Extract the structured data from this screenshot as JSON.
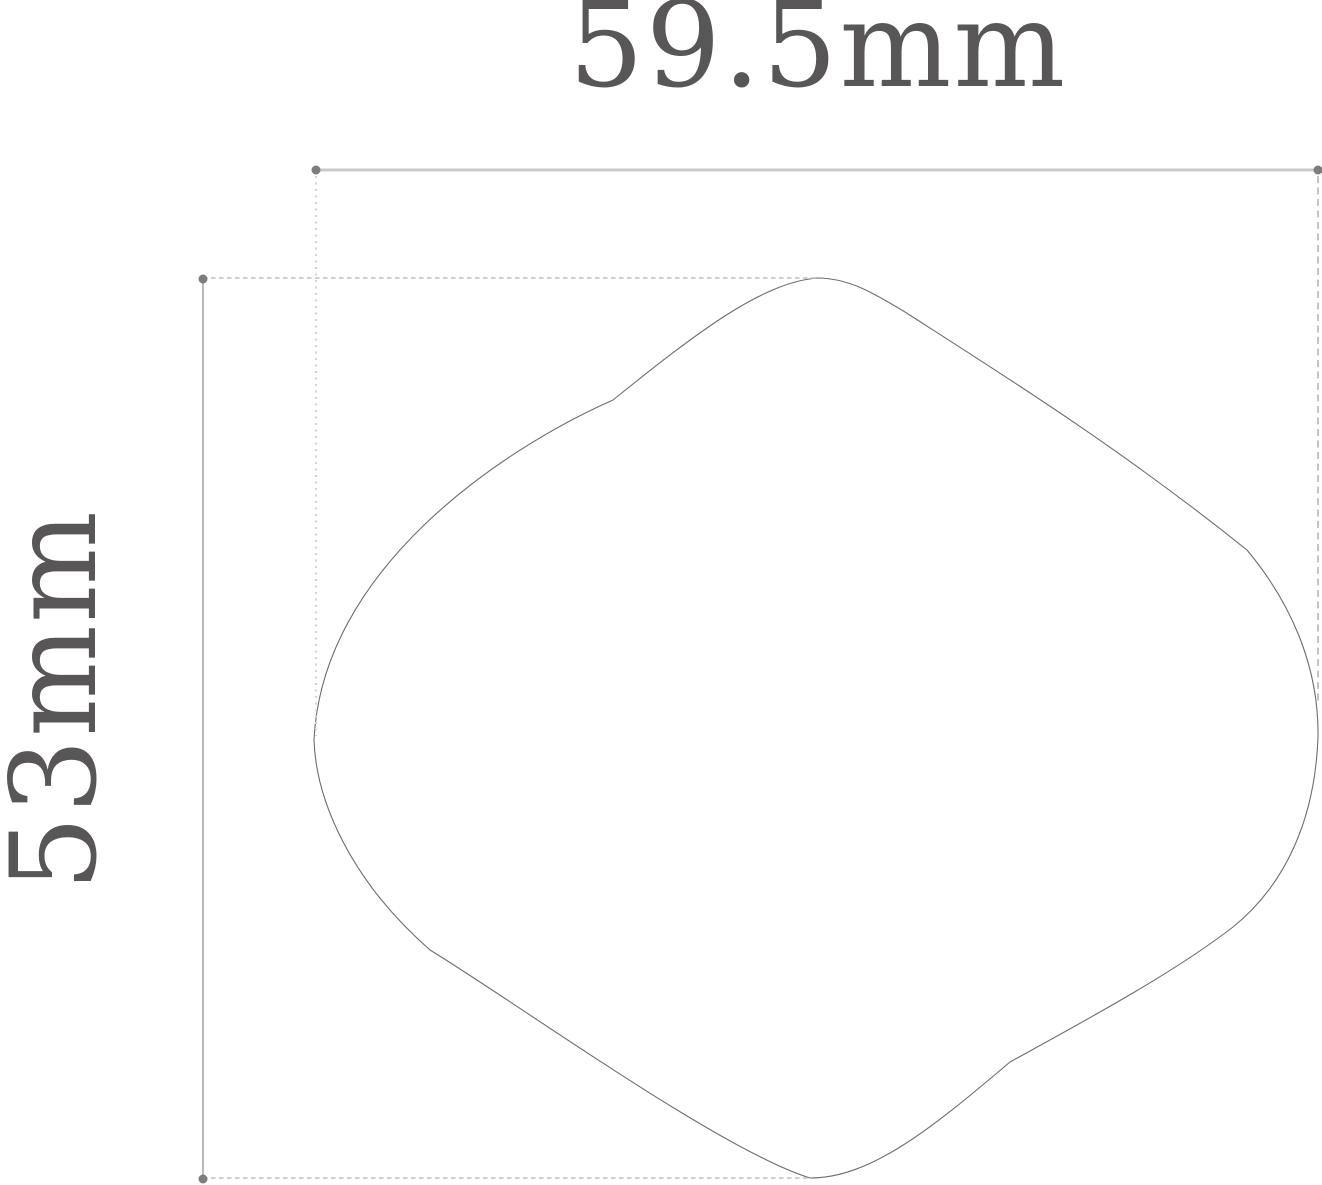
{
  "drawing": {
    "type": "dimensioned technical outline drawing",
    "width_dimension": {
      "label": "59.5mm",
      "value": 59.5,
      "unit": "mm",
      "orientation": "horizontal"
    },
    "height_dimension": {
      "label": "53mm",
      "value": 53,
      "unit": "mm",
      "orientation": "vertical"
    },
    "shape": {
      "description": "smooth closed leaf / quince-like outline with pointed top peak and rounded bottom tip"
    }
  },
  "colors": {
    "background": "#ffffff",
    "label_text": "#595657",
    "outline": "#6f6c6d",
    "dimension_line": "#c9c9c9",
    "dimension_line_vertical": "#b3b3b3",
    "extension_dashed": "#bdbdbd",
    "extension_dotted": "#d5d5d5",
    "marker_dot": "#7d7d7d"
  }
}
